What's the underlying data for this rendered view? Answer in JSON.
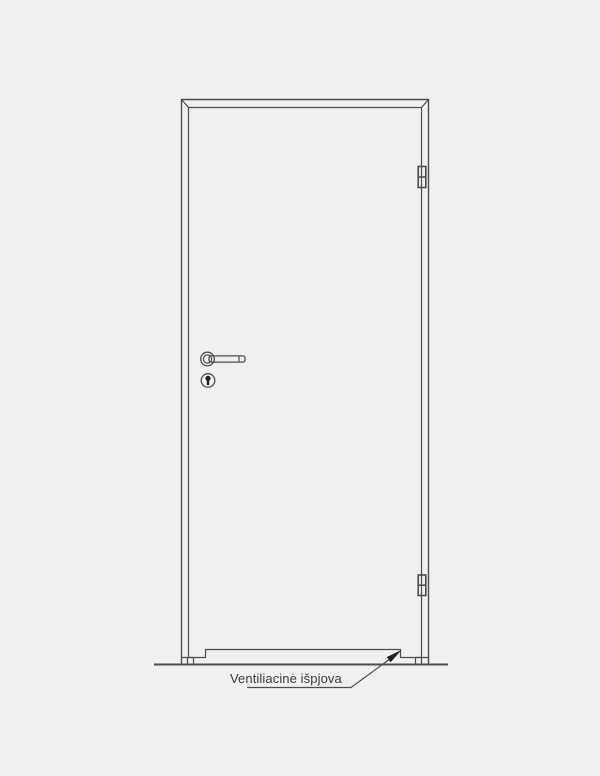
{
  "annotation": {
    "label": "Ventiliacinė išpjova"
  },
  "colors": {
    "background": "#f0f0f0",
    "line": "#4d4d4d",
    "text": "#3a3a3a",
    "arrow_fill": "#1f1f1f"
  },
  "parts": {
    "door_frame": "door-frame",
    "door_leaf": "door-leaf",
    "top_hinge": "top-hinge",
    "bottom_hinge": "bottom-hinge",
    "door_handle": "door-handle",
    "keyhole": "keyhole",
    "ventilation_cutout": "ventilation-cutout",
    "floor_line": "floor-line",
    "leader_arrow": "leader-arrow"
  }
}
